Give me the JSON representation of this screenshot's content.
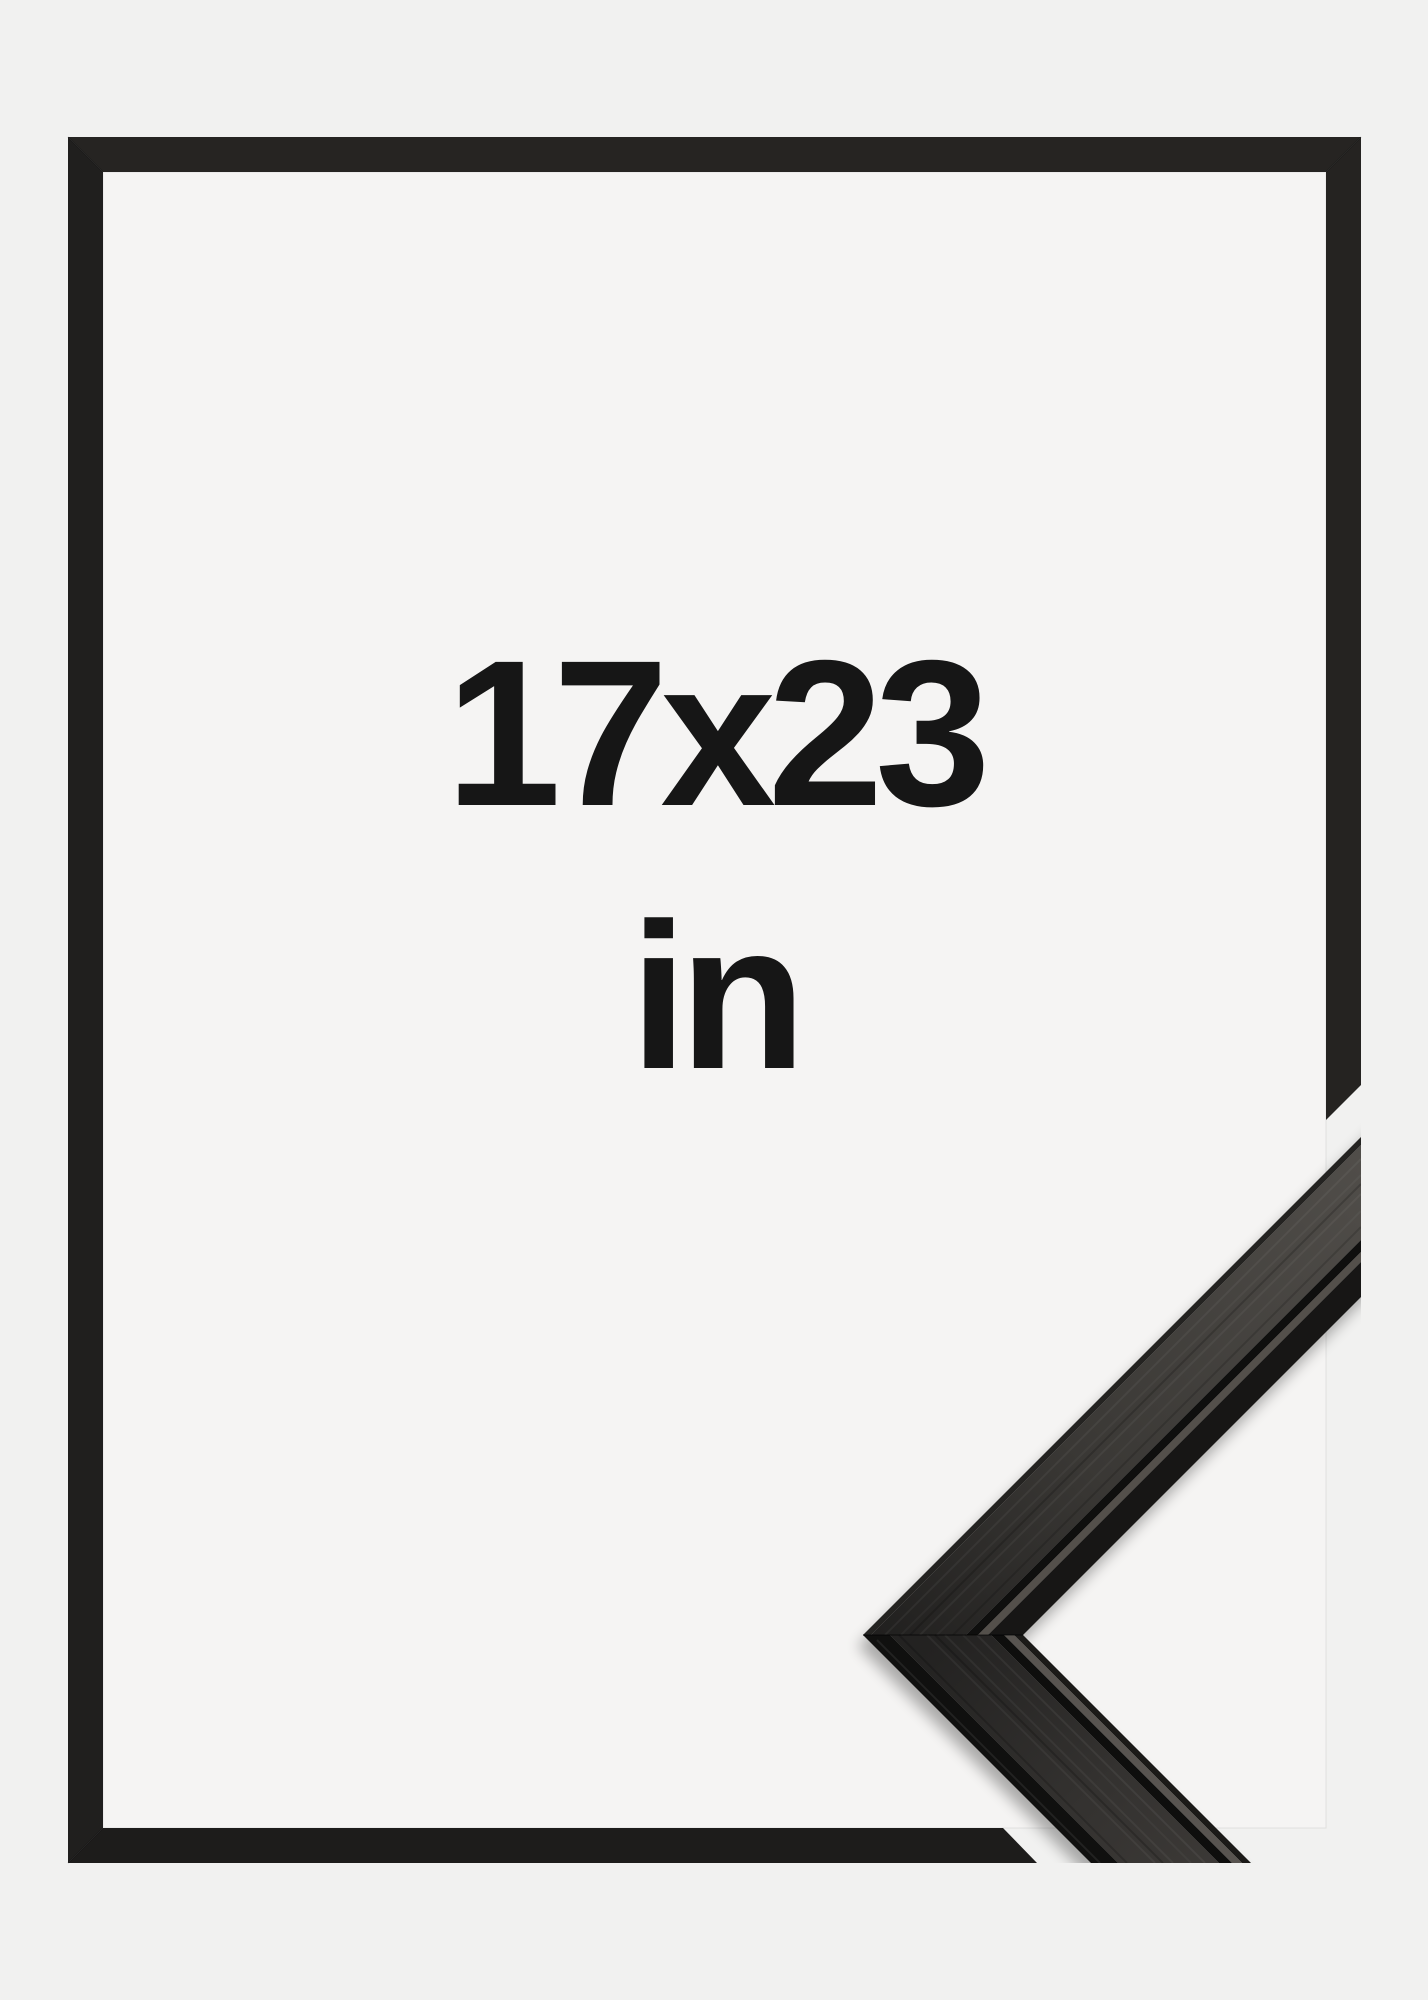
{
  "frame_mockup": {
    "size_label": "17x23",
    "unit_label": "in",
    "colors": {
      "background": "#f1f1f0",
      "mat_interior": "#f5f4f3",
      "frame_outline_black": "#232120",
      "label_text": "#161616",
      "moulding_face_dark": "#26241f",
      "moulding_face_light": "#514e4a",
      "moulding_groove": "#0f0f0e",
      "moulding_lip_highlight": "#585450"
    }
  }
}
